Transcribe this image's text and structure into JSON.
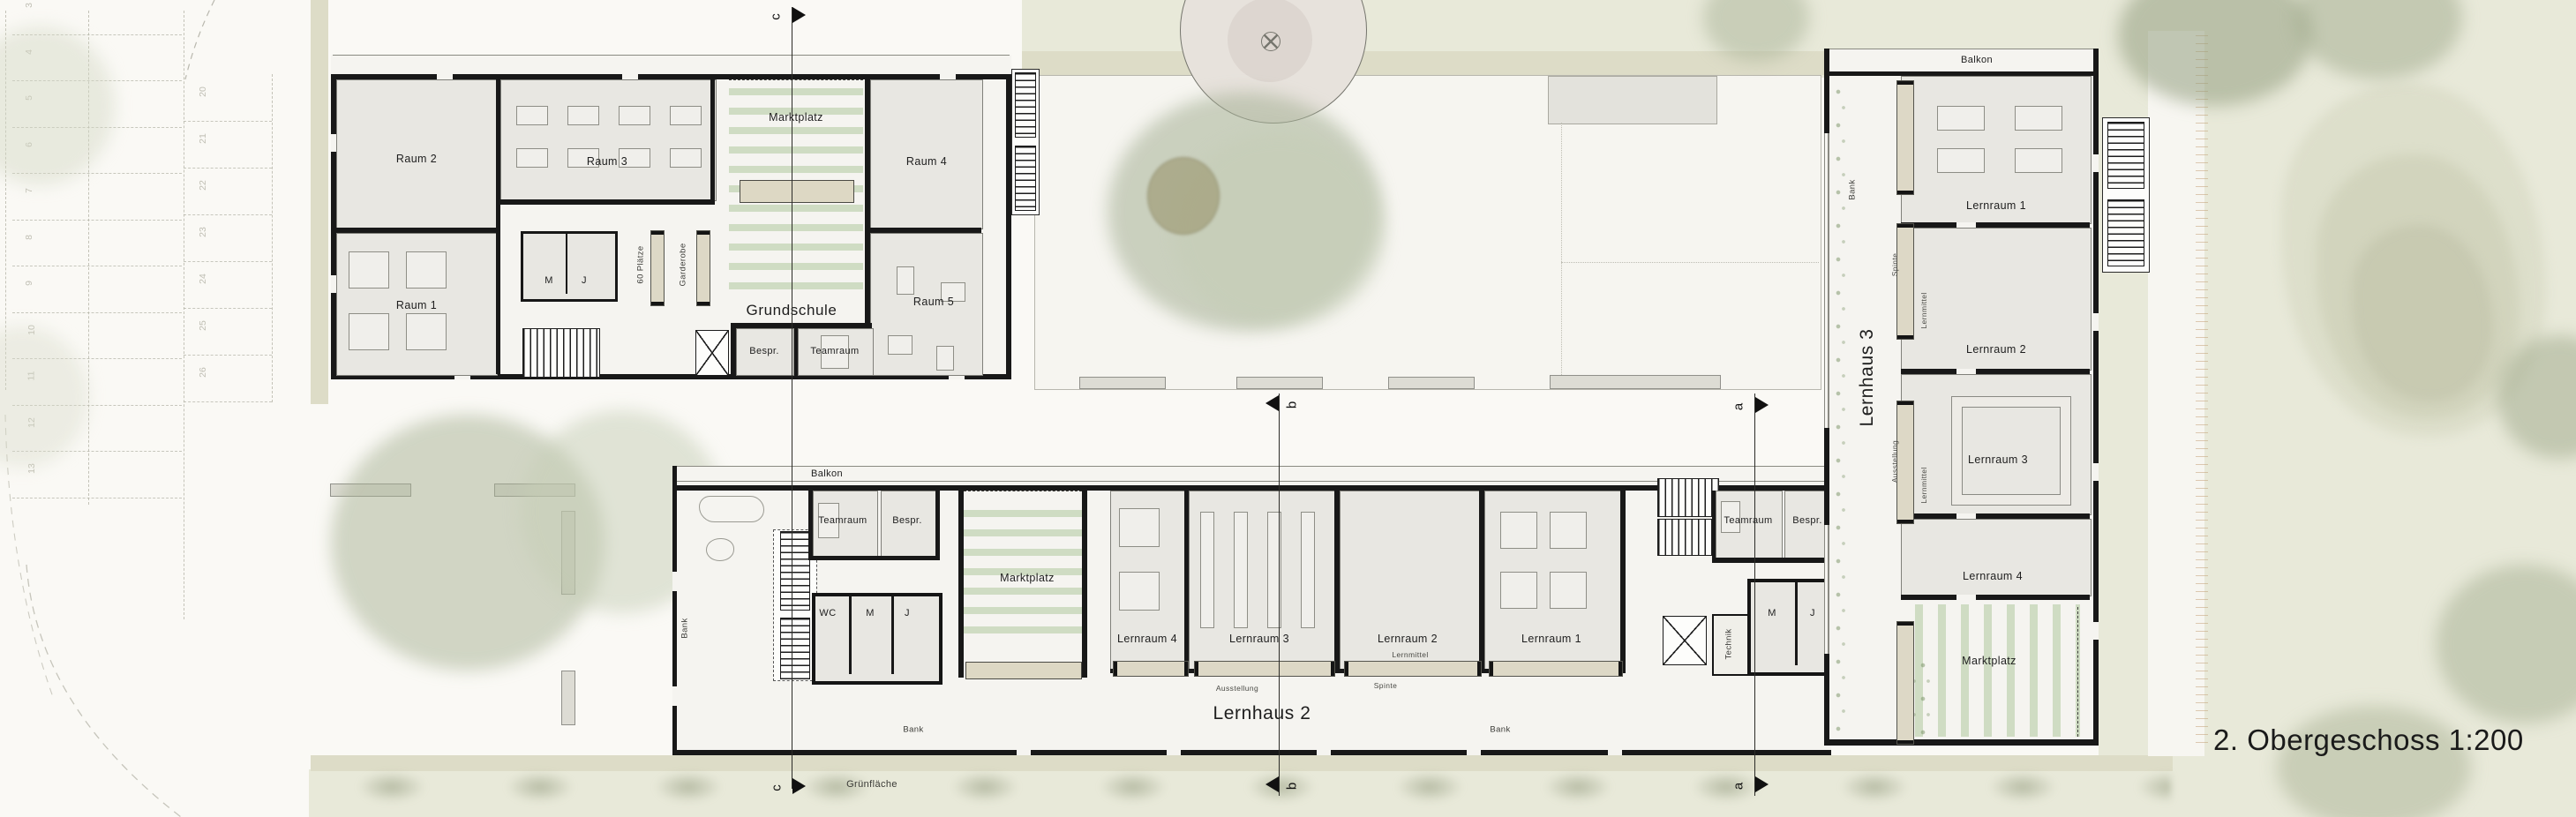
{
  "title": "2. Obergeschoss 1:200",
  "sections": {
    "a": "a",
    "b": "b",
    "c": "c"
  },
  "site": {
    "gruenflaeche": "Grünfläche",
    "parking_left_numbers": [
      "3",
      "4",
      "5",
      "6",
      "7",
      "8",
      "9",
      "10",
      "11",
      "12",
      "13"
    ],
    "parking_right_numbers": [
      "20",
      "21",
      "22",
      "23",
      "24",
      "25",
      "26"
    ]
  },
  "colors": {
    "wall": "#181818",
    "room_fill": "#e8e7e2",
    "marktplatz_stripe": "#cfdcc3",
    "grass": "#e8e9d9",
    "path": "#dddcc7"
  },
  "grundschule": {
    "name": "Grundschule",
    "raum1": "Raum 1",
    "raum2": "Raum 2",
    "raum3": "Raum 3",
    "raum4": "Raum 4",
    "raum5": "Raum 5",
    "marktplatz": "Marktplatz",
    "plaetze": "60 Plätze",
    "garderobe": "Garderobe",
    "wc_m": "M",
    "wc_j": "J",
    "bespr": "Bespr.",
    "teamraum": "Teamraum"
  },
  "lernhaus2": {
    "name": "Lernhaus 2",
    "balkon": "Balkon",
    "bank_left": "Bank",
    "bank_mid": "Bank",
    "bank_right": "Bank",
    "teamraum_left": "Teamraum",
    "bespr_left": "Bespr.",
    "wc": "WC",
    "m_left": "M",
    "j_left": "J",
    "marktplatz": "Marktplatz",
    "lernraum1": "Lernraum 1",
    "lernraum2": "Lernraum 2",
    "lernraum3": "Lernraum 3",
    "lernraum4": "Lernraum 4",
    "lernmittel": "Lernmittel",
    "spinte": "Spinte",
    "ausstellung": "Ausstellung",
    "teamraum_right": "Teamraum",
    "bespr_right": "Bespr.",
    "technik": "Technik",
    "m_right": "M",
    "j_right": "J"
  },
  "lernhaus3": {
    "name": "Lernhaus 3",
    "balkon": "Balkon",
    "bank": "Bank",
    "lernraum1": "Lernraum 1",
    "lernraum2": "Lernraum 2",
    "lernraum3": "Lernraum 3",
    "lernraum4": "Lernraum 4",
    "marktplatz": "Marktplatz",
    "spinte": "Spinte",
    "lernmittel_top": "Lernmittel",
    "lernmittel_bottom": "Lernmittel",
    "ausstellung": "Ausstellung"
  }
}
